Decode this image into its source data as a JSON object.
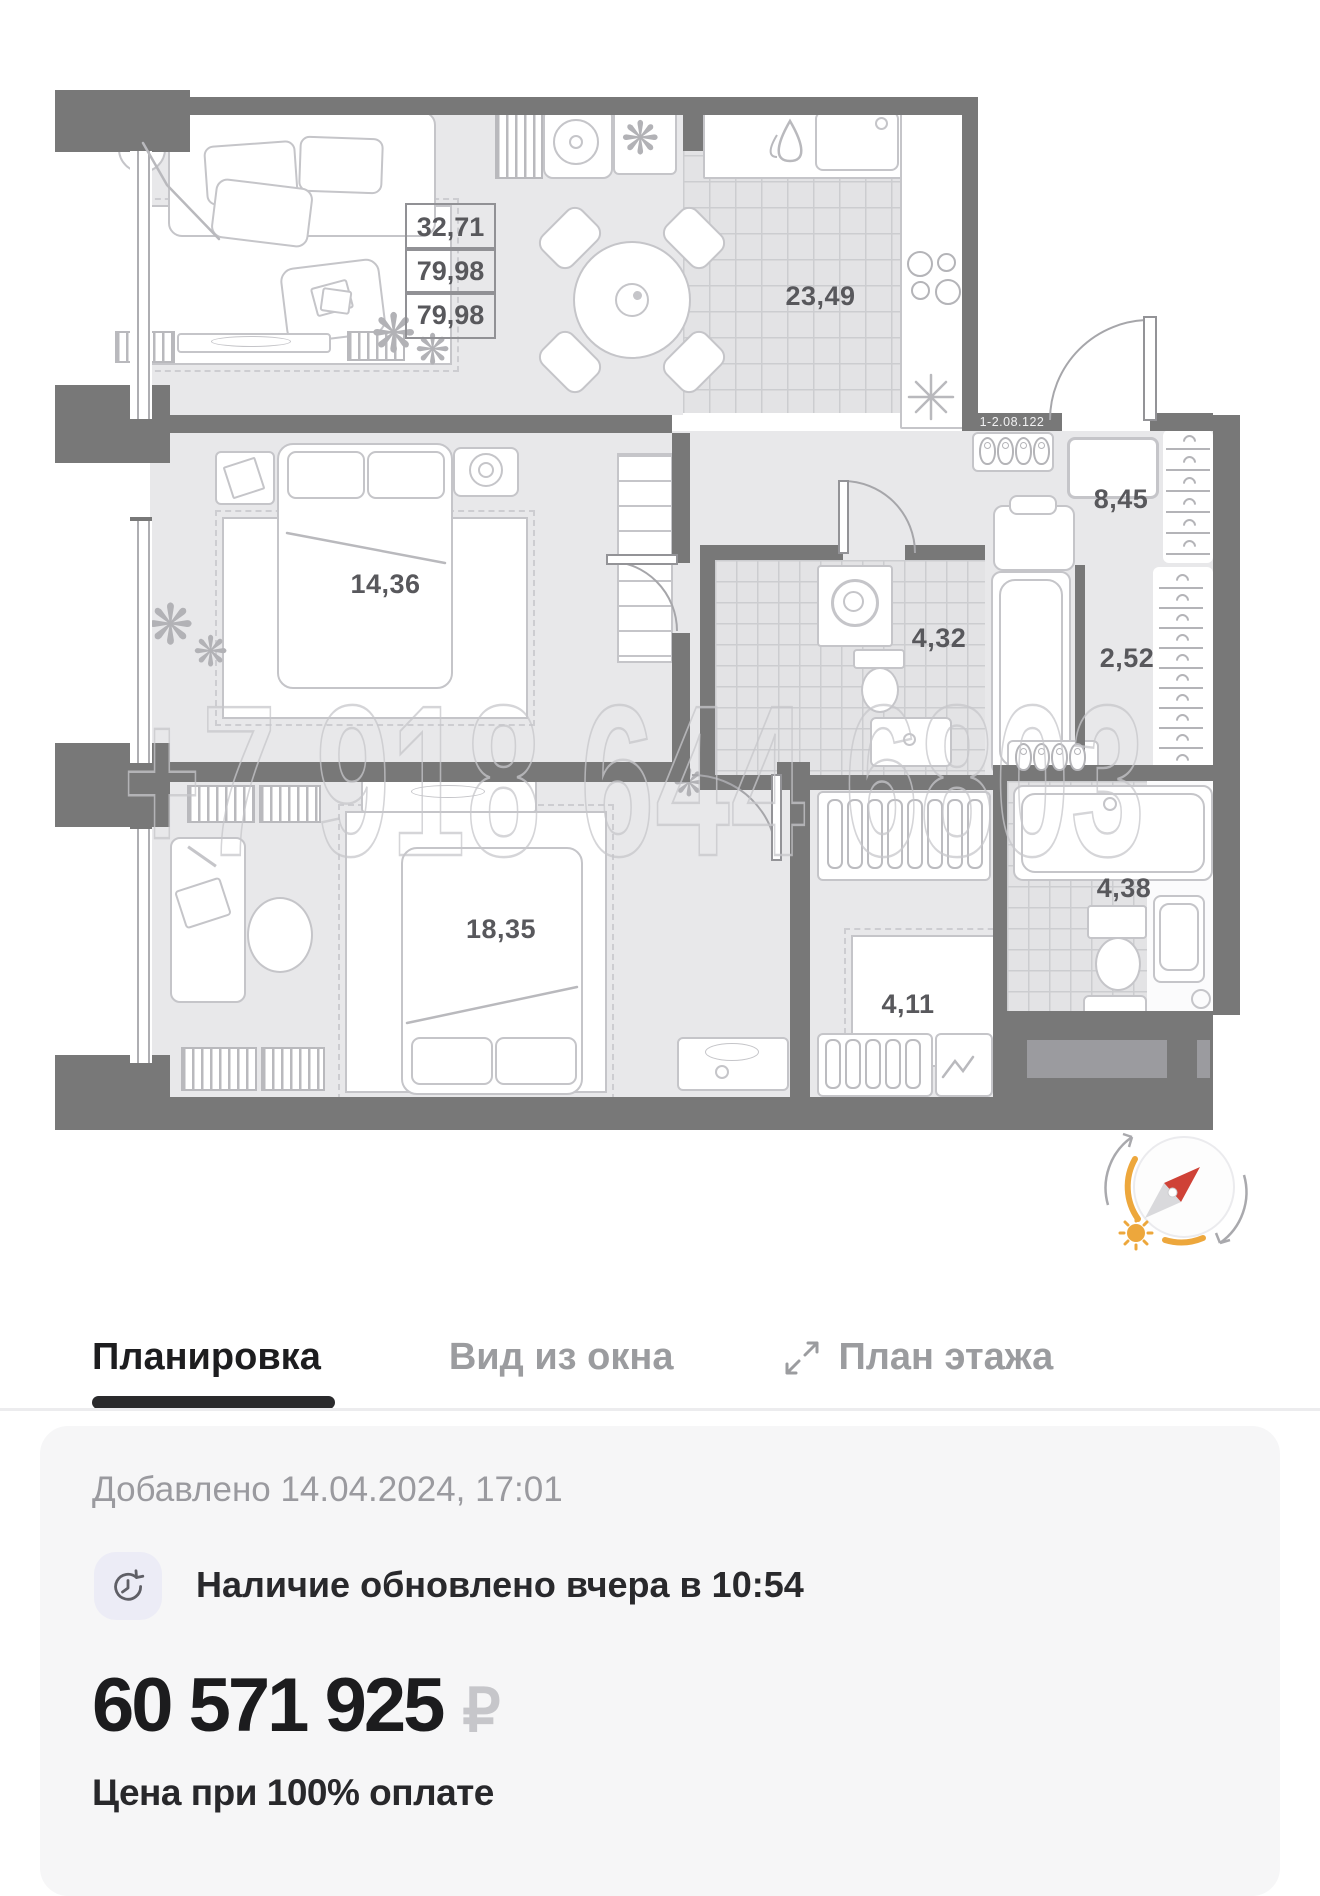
{
  "floorplan": {
    "watermark_phone": "+7 918 644 6803",
    "apartment_code": "1-2.08.122",
    "stacked_area_labels": [
      "32,71",
      "79,98",
      "79,98"
    ],
    "room_labels": {
      "kitchen_dining": "23,49",
      "bedroom": "14,36",
      "hallway": "8,45",
      "bathroom": "4,32",
      "corridor": "2,52",
      "master_bedroom": "18,35",
      "wardrobe": "4,11",
      "bathroom_2": "4,38"
    }
  },
  "tabs": {
    "layout": "Планировка",
    "window_view": "Вид из окна",
    "floor_plan": "План этажа"
  },
  "card": {
    "added": "Добавлено 14.04.2024, 17:01",
    "availability": "Наличие обновлено вчера в 10:54",
    "price": "60 571 925",
    "currency": "₽",
    "price_note": "Цена при 100% оплате"
  },
  "colors": {
    "wall": "#787878",
    "floor": "#e8e8ea",
    "accent_orange": "#eda73c",
    "needle_red": "#cf4237",
    "active_tab": "#1d1d1f",
    "inactive_tab": "#9b9c9f",
    "card_bg": "#f6f6f7"
  }
}
